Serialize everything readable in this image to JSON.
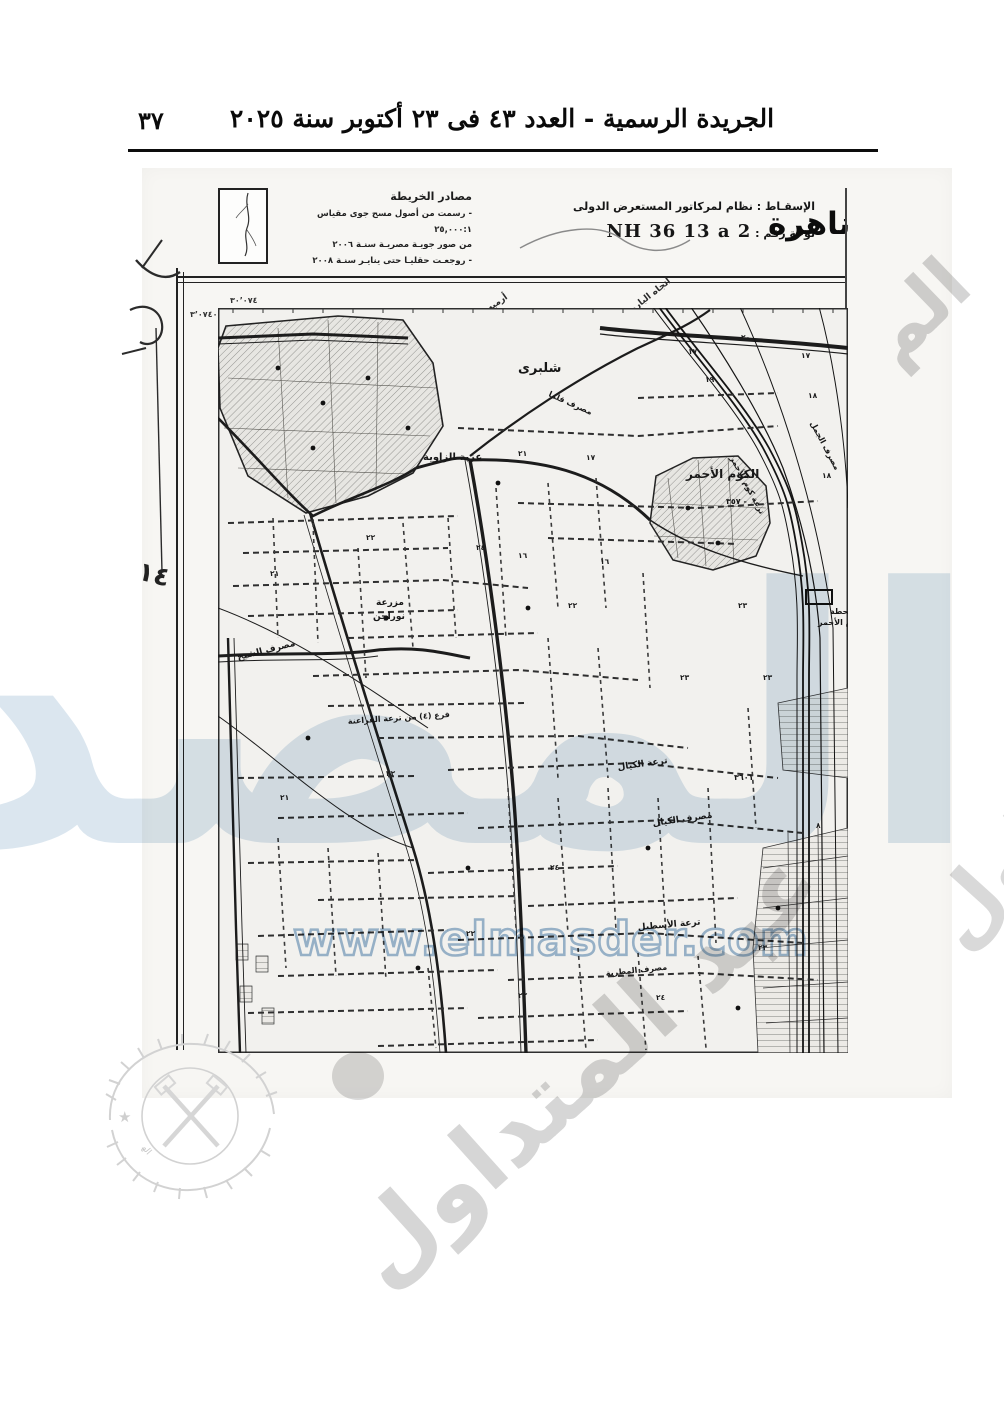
{
  "page": {
    "number": "٣٧",
    "header_title": "الجريدة الرسمية - العدد ٤٣ فى ٢٣ أكتوبر سنة ٢٠٢٥"
  },
  "map_header": {
    "city_partial": "ناهرة",
    "sources_title": "مصادر الخريطة",
    "source_lines": [
      "- رسمت من أصول مسح جوى مقياس ٢٥,٠٠٠:١",
      "من صور جويـة مصريـة سنـة ٢٠٠٦",
      "- روجعـت حقليـا حتى ينايـر سنـة ٢٠٠٨"
    ],
    "projection_line": "الإسقـاط : نظام لمركاتور المستعرض الدولى",
    "plate_label": "لوحة رقم :",
    "plate_value": "NH 36 13 a 2"
  },
  "margins": {
    "grid_number_top": "٣٠٬٠٧٤",
    "grid_number_left": "٣٬٠٧٤٠",
    "handwritten_left": "٢٠",
    "handwritten_left_2": "١٤",
    "top_edge_label_1": "أرميه",
    "top_edge_label_2": "اتجاه البارود"
  },
  "watermarks": {
    "url_text": "www.elmasder.com",
    "brand_text": "المصدر",
    "diagonal_text": "عبد المتداول",
    "diagonal_fragment": "الم",
    "stamp_text": "الهيئة العامة لشئون المطابع الأميرية"
  },
  "map": {
    "labels": [
      {
        "text": "شلبرى",
        "x": 300,
        "y": 64,
        "s": 13,
        "r": 0
      },
      {
        "text": "عزبة الزاوية",
        "x": 205,
        "y": 152,
        "s": 10,
        "r": 0
      },
      {
        "text": "الكوم الأحمر",
        "x": 468,
        "y": 170,
        "s": 12,
        "r": 0
      },
      {
        "text": "محطة",
        "x": 612,
        "y": 306,
        "s": 8,
        "r": 0
      },
      {
        "text": "الكوم الأحمر",
        "x": 600,
        "y": 317,
        "s": 8,
        "r": 0
      },
      {
        "text": "مزرعة",
        "x": 158,
        "y": 297,
        "s": 9,
        "r": 0
      },
      {
        "text": "نوراجن",
        "x": 155,
        "y": 311,
        "s": 9,
        "r": 0
      },
      {
        "text": "مصرف الشيخ",
        "x": 20,
        "y": 352,
        "s": 9,
        "r": -14
      },
      {
        "text": "فرع (٤) من ترعة الفراعنة",
        "x": 130,
        "y": 416,
        "s": 8,
        "r": -4
      },
      {
        "text": "ترعة الكيال",
        "x": 400,
        "y": 462,
        "s": 9,
        "r": -8
      },
      {
        "text": "مصرف الكيال",
        "x": 435,
        "y": 518,
        "s": 9,
        "r": -8
      },
      {
        "text": "ترعة الأسطبل",
        "x": 420,
        "y": 622,
        "s": 9,
        "r": -5
      },
      {
        "text": "مصرف المطرية",
        "x": 388,
        "y": 668,
        "s": 8,
        "r": -6
      },
      {
        "text": "ترعة كوم الأحمر",
        "x": 512,
        "y": 150,
        "s": 8,
        "r": 62
      },
      {
        "text": "مصرف الجمل",
        "x": 592,
        "y": 115,
        "s": 8,
        "r": 62
      },
      {
        "text": "مصرف قلما",
        "x": 330,
        "y": 88,
        "s": 8,
        "r": 24
      },
      {
        "text": "٣٥٧ -",
        "x": 508,
        "y": 196,
        "s": 8,
        "r": 0
      },
      {
        "text": "٣٦٠١",
        "x": 516,
        "y": 472,
        "s": 8,
        "r": 0
      }
    ],
    "numbers": [
      {
        "text": "٢٠",
        "x": 523,
        "y": 32
      },
      {
        "text": "١٧",
        "x": 470,
        "y": 46
      },
      {
        "text": "١٩",
        "x": 487,
        "y": 74
      },
      {
        "text": "١٧",
        "x": 583,
        "y": 50
      },
      {
        "text": "١٨",
        "x": 604,
        "y": 170
      },
      {
        "text": "٢١",
        "x": 300,
        "y": 148
      },
      {
        "text": "١٧",
        "x": 368,
        "y": 152
      },
      {
        "text": "٢٢",
        "x": 148,
        "y": 232
      },
      {
        "text": "٢١",
        "x": 52,
        "y": 268
      },
      {
        "text": "٢٤",
        "x": 258,
        "y": 242
      },
      {
        "text": "١٦",
        "x": 382,
        "y": 256
      },
      {
        "text": "٢٢",
        "x": 350,
        "y": 300
      },
      {
        "text": "٢٣",
        "x": 520,
        "y": 300
      },
      {
        "text": "٢٣",
        "x": 462,
        "y": 372
      },
      {
        "text": "٢٢",
        "x": 168,
        "y": 468
      },
      {
        "text": "٢١",
        "x": 62,
        "y": 492
      },
      {
        "text": "٢٣",
        "x": 545,
        "y": 372
      },
      {
        "text": "٢٢",
        "x": 248,
        "y": 628
      },
      {
        "text": "٢٣",
        "x": 540,
        "y": 642
      },
      {
        "text": "٢٤",
        "x": 332,
        "y": 562
      },
      {
        "text": "٨",
        "x": 598,
        "y": 520
      },
      {
        "text": "٢٢",
        "x": 300,
        "y": 690
      },
      {
        "text": "٢٤",
        "x": 438,
        "y": 692
      },
      {
        "text": "١٦",
        "x": 300,
        "y": 250
      },
      {
        "text": "١٨",
        "x": 590,
        "y": 90
      }
    ]
  }
}
